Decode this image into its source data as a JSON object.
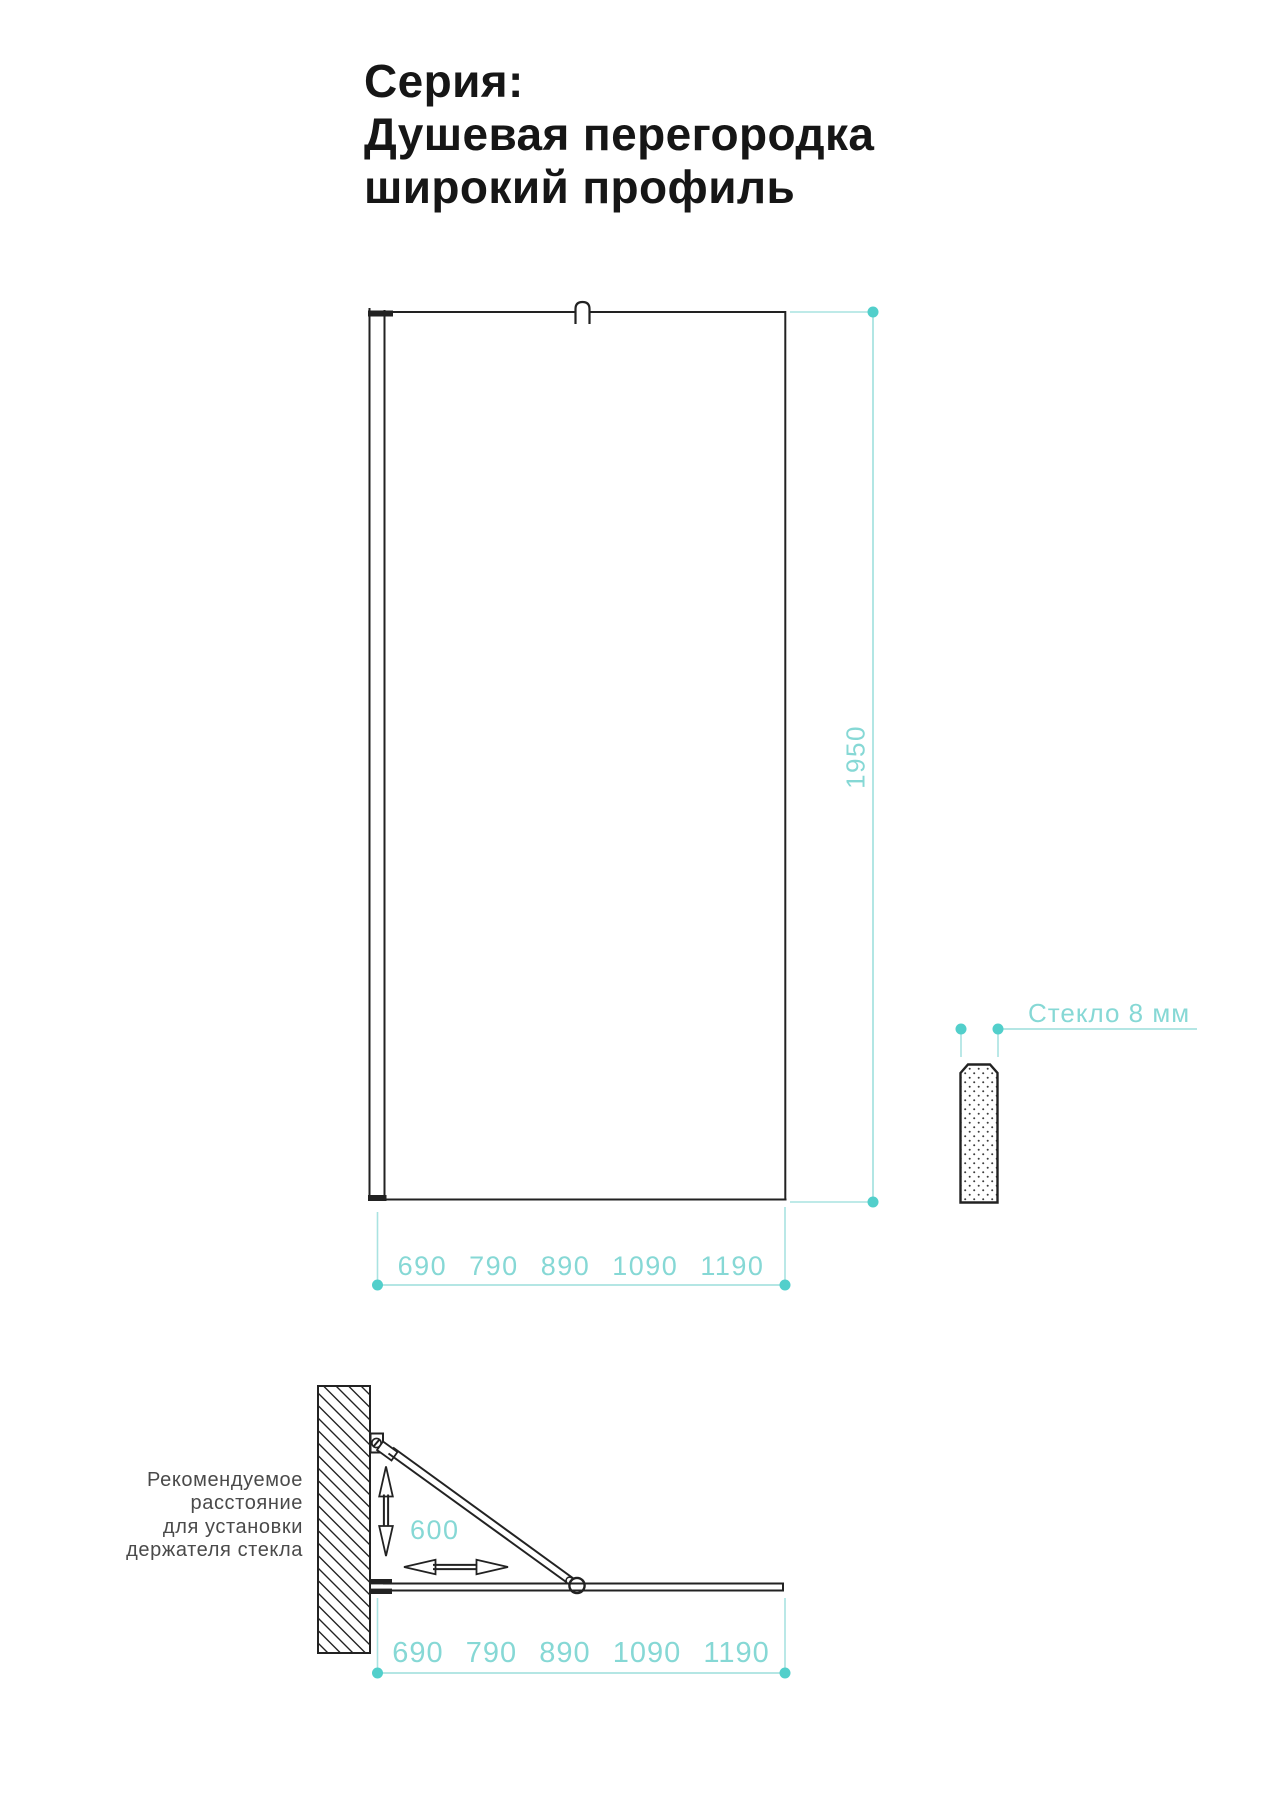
{
  "page": {
    "title_lines": [
      "Серия:",
      "Душевая перегородка",
      "широкий профиль"
    ]
  },
  "front_view": {
    "height_label": "1950",
    "width_labels": [
      "690",
      "790",
      "890",
      "1090",
      "1190"
    ]
  },
  "glass_section": {
    "label": "Стекло 8 мм"
  },
  "plan_view": {
    "holder_distance_label": "600",
    "width_labels": [
      "690",
      "790",
      "890",
      "1090",
      "1190"
    ],
    "note_lines": [
      "Рекомендуемое",
      "расстояние",
      "для установки",
      "держателя стекла"
    ]
  },
  "theme": {
    "ink": "#222222",
    "teal_text": "#86d8d5",
    "teal_line": "#a9e3e1",
    "teal_dot": "#52cfcb",
    "note_gray": "#4a4a4a",
    "background": "#ffffff"
  }
}
